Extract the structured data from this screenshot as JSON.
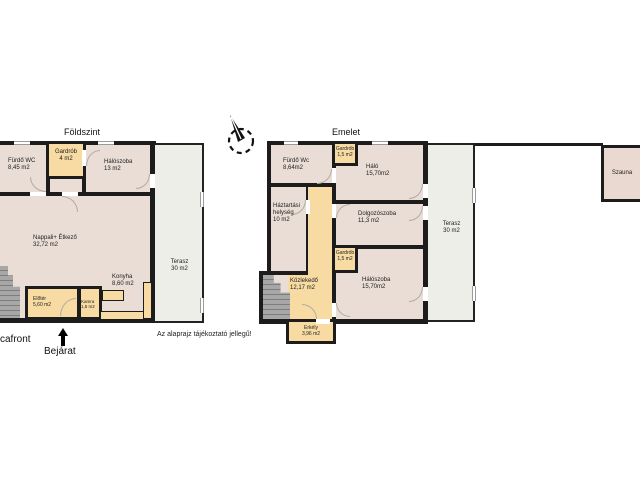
{
  "page": {
    "disclaimer": "Az alaprajz tájékoztató jellegű!",
    "street_label": "cafront",
    "entrance_label": "Bejárat"
  },
  "colors": {
    "wall": "#1c1c1c",
    "room_fill": "#e9ddd5",
    "service_fill": "#f7dba3",
    "terrace_fill": "#edeee8",
    "stairs_fill": "#a7a7a7"
  },
  "ground_floor": {
    "title": "Földszint",
    "rooms": [
      {
        "name": "Fürdő WC",
        "area": "8,45 m2"
      },
      {
        "name": "Gardrób",
        "area": "4 m2"
      },
      {
        "name": "Hálószoba",
        "area": "13 m2"
      },
      {
        "name": "Nappali+ Étkező",
        "area": "32,72 m2"
      },
      {
        "name": "Konyha",
        "area": "8,60 m2"
      },
      {
        "name": "Előtér",
        "area": "5,60 m2"
      },
      {
        "name": "Kamra",
        "area": "1,6 m2"
      },
      {
        "name": "Terasz",
        "area": "30 m2"
      }
    ]
  },
  "upper_floor": {
    "title": "Emelet",
    "rooms": [
      {
        "name": "Fürdő Wc",
        "area": "8,64m2"
      },
      {
        "name": "Gardrób",
        "area": "1,5 m2"
      },
      {
        "name": "Háló",
        "area": "15,70m2"
      },
      {
        "name": "Háztartási helység",
        "area": "10 m2"
      },
      {
        "name": "Dolgozószoba",
        "area": "11,3 m2"
      },
      {
        "name": "Gardrób",
        "area": "1,5 m2"
      },
      {
        "name": "Hálószoba",
        "area": "15,70m2"
      },
      {
        "name": "Közlekedő",
        "area": "12,17 m2"
      },
      {
        "name": "Erkély",
        "area": "3,96 m2"
      },
      {
        "name": "Terasz",
        "area": "30 m2"
      },
      {
        "name": "Szauna",
        "area": ""
      }
    ]
  }
}
